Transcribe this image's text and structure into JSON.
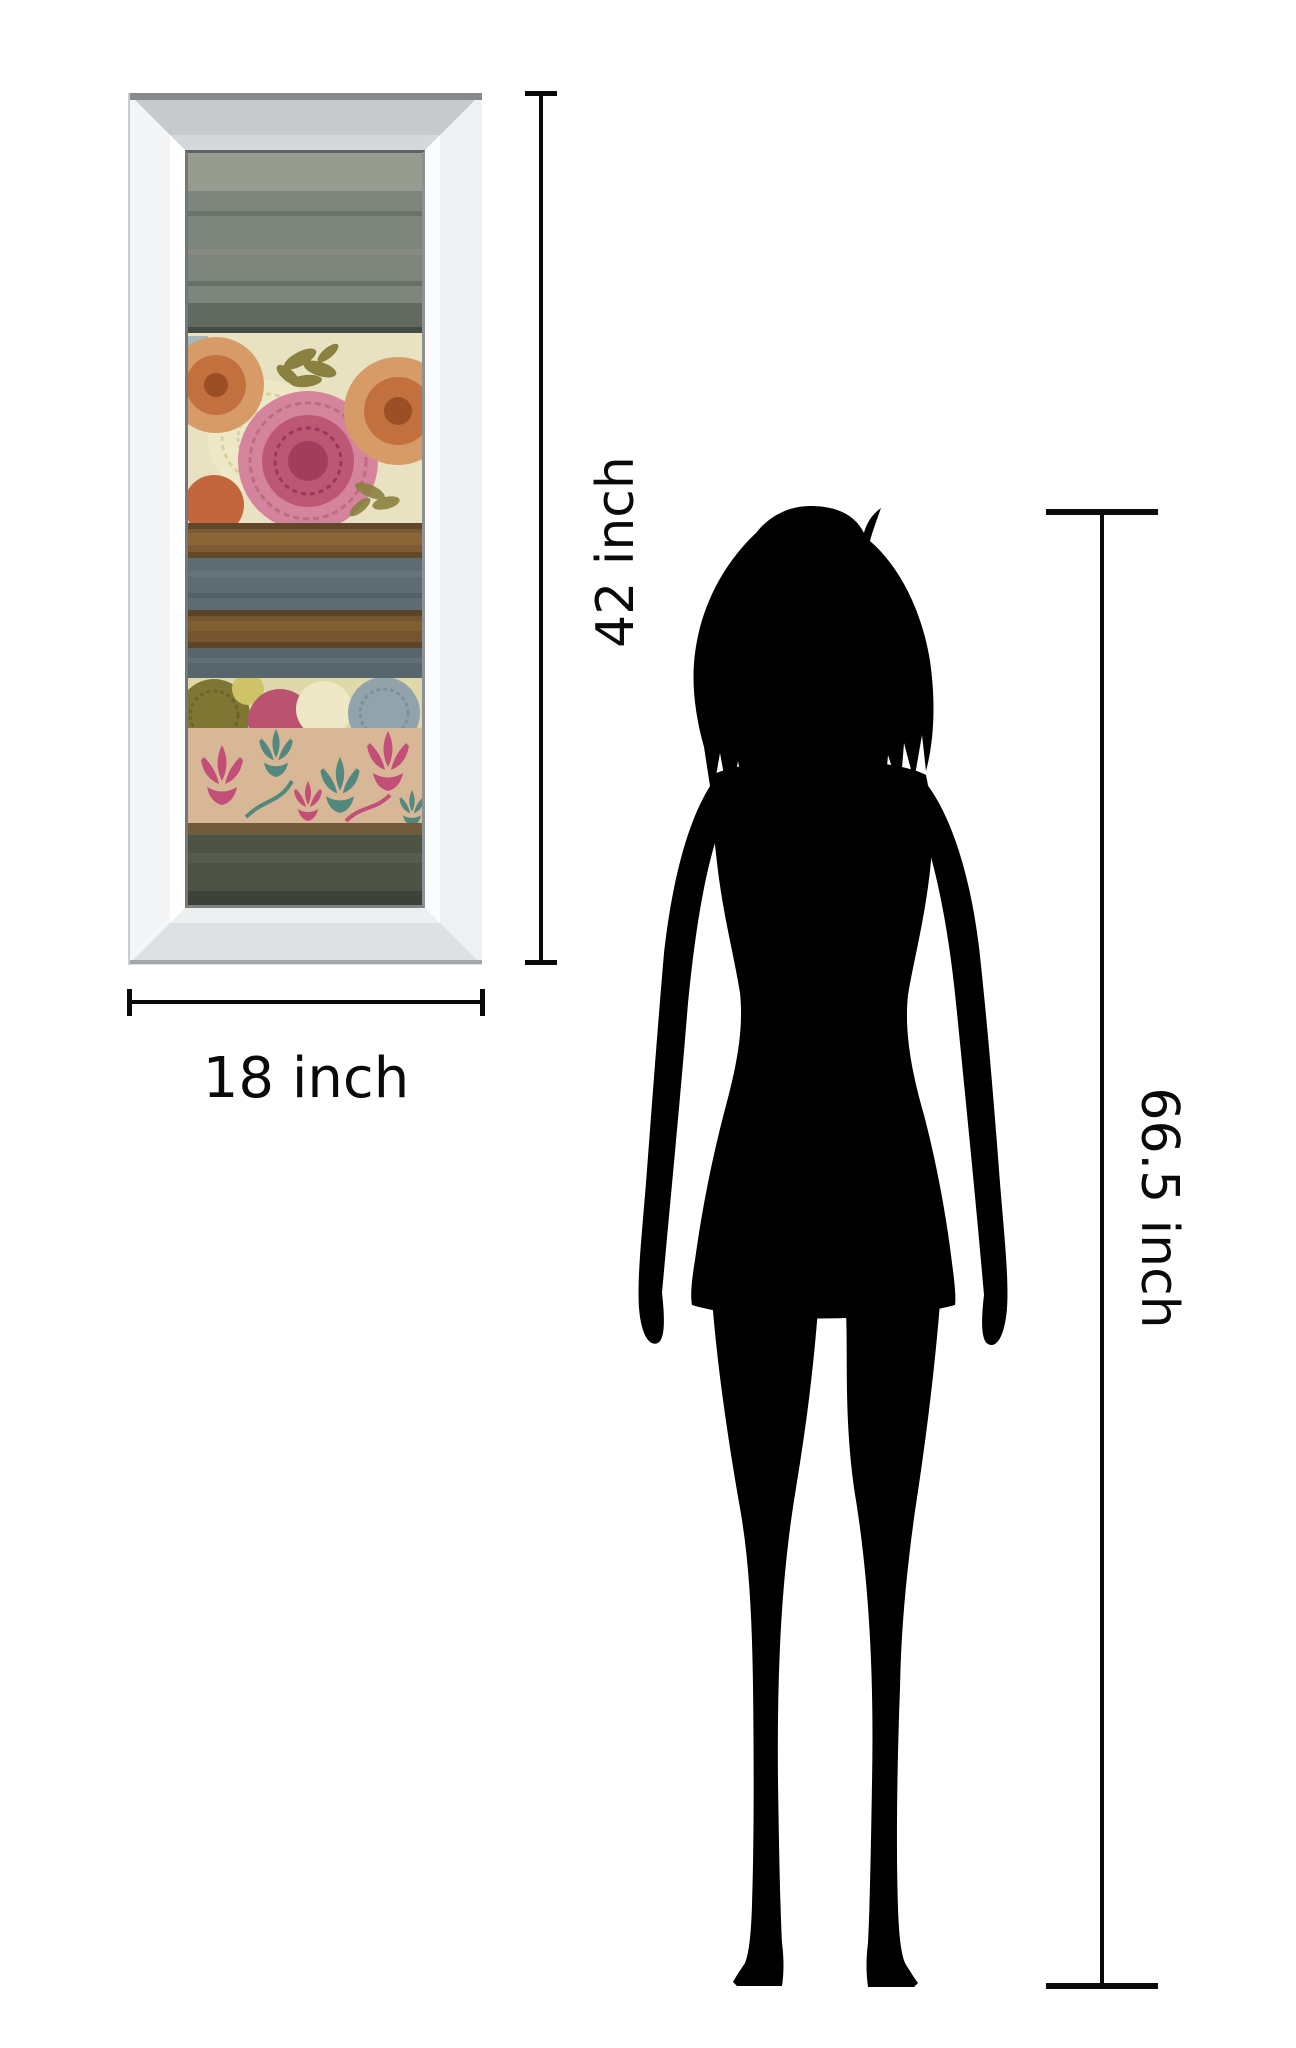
{
  "labels": {
    "frame_height": "42 inch",
    "frame_width": "18 inch",
    "person_height": "66.5 inch"
  },
  "palette": {
    "background": "#ffffff",
    "dimension_line": "#0a0a0a",
    "dimension_text": "#0a0a0a",
    "silhouette": "#000000",
    "frame_face": "#eef1f2",
    "frame_edge_dark": "#868a8d",
    "pale_blue": "#9fb4c0",
    "pink_mum": "#d4849c",
    "pink_mum_dark": "#b9536f",
    "pink_mum_core": "#a03e5c",
    "orange_mum": "#c2703e",
    "orange_mum_light": "#d79b68",
    "orange_mum_core": "#9c4e24",
    "red_mum": "#c0592f",
    "cream_mum": "#eee8c6",
    "gold_mum": "#cfc36a",
    "olive_leaf": "#8a8140",
    "olive_mum": "#7f7634",
    "blue_mum": "#93a3ab",
    "damask_pink": "#c34f78",
    "damask_teal": "#53887e"
  },
  "artwork": {
    "bands": [
      {
        "name": "gray-wash",
        "color": "#7e857c"
      },
      {
        "name": "floral-mum-band",
        "color": "#e9e2c2"
      },
      {
        "name": "rust-stripe",
        "color": "#7d5a33"
      },
      {
        "name": "slate-band",
        "color": "#5d6b73"
      },
      {
        "name": "brown-stripe",
        "color": "#75552f"
      },
      {
        "name": "slate-band-lower",
        "color": "#57656d"
      },
      {
        "name": "mum-strip",
        "color": "#ded8ab"
      },
      {
        "name": "damask-band",
        "color": "#d8b797"
      },
      {
        "name": "dark-olive-band",
        "color": "#4c5244"
      }
    ]
  }
}
